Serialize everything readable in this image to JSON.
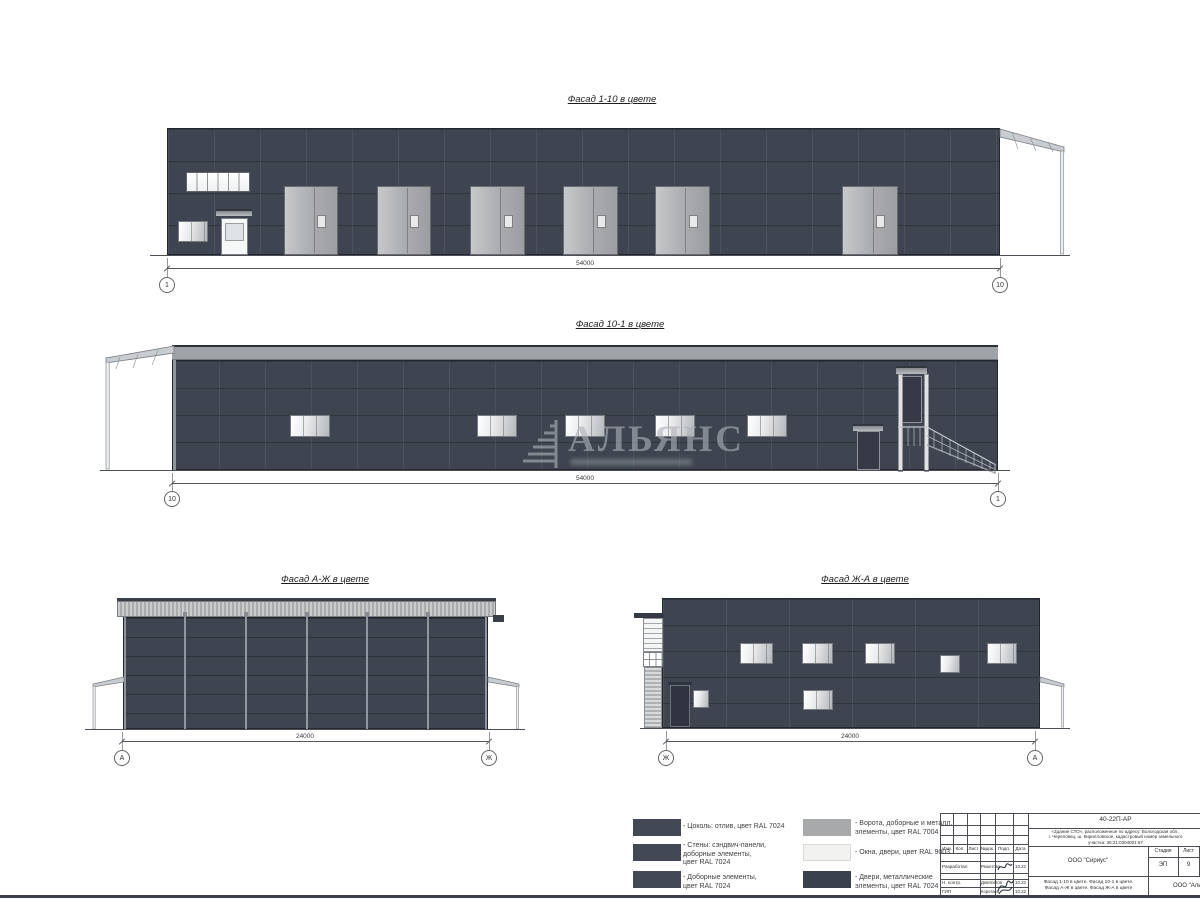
{
  "watermark": {
    "text": "АЛЬЯНС",
    "logo": "alliance-triangle-logo"
  },
  "facades": [
    {
      "title": "Фасад 1-10 в цвете",
      "dimension": "54000",
      "marker_left": "1",
      "marker_right": "10"
    },
    {
      "title": "Фасад 10-1 в цвете",
      "dimension": "54000",
      "marker_left": "10",
      "marker_right": "1"
    },
    {
      "title": "Фасад А-Ж в цвете",
      "dimension": "24000",
      "marker_left": "А",
      "marker_right": "Ж"
    },
    {
      "title": "Фасад Ж-А в цвете",
      "dimension": "24000",
      "marker_left": "Ж",
      "marker_right": "А"
    }
  ],
  "legend": {
    "items": [
      {
        "swatch": "#424854",
        "label": "- Цоколь: отлив, цвет RAL 7024"
      },
      {
        "swatch": "#424854",
        "label": "- Стены: сэндвич-панели,\nдоборные элементы,\nцвет RAL 7024"
      },
      {
        "swatch": "#424854",
        "label": "- Доборные элементы,\nцвет RAL 7024"
      },
      {
        "swatch": "#a7a9ab",
        "label": "- Ворота, доборные и металл.\nэлементы, цвет RAL 7004"
      },
      {
        "swatch": "#f2f3f0",
        "label": "- Окна, двери, цвет RAL 9003"
      },
      {
        "swatch": "#3a404c",
        "label": "- Двери, металлические\nэлементы, цвет RAL 7024"
      }
    ]
  },
  "title_block": {
    "doc_number": "40-22П-АР",
    "project_description": "«Здание СТО», расположенное по адресу: Вологодская обл.,\nг. Череповец, ш. Кирилловское, кадастровый номер земельного\nучастка: 35:21:0304001:67",
    "columns": [
      "Изм.",
      "Коп.",
      "Лист",
      "№док.",
      "Подп.",
      "Дата"
    ],
    "rows": [
      {
        "role": "Разработал",
        "name": "Решетова",
        "date": "10.22"
      },
      {
        "role": "Н. контр.",
        "name": "Девятилов",
        "date": "10.22"
      },
      {
        "role": "ГИП",
        "name": "Коротаев",
        "date": "10.22"
      }
    ],
    "customer": "ООО \"Сириус\"",
    "stage_label": "Стадия",
    "sheet_label": "Лист",
    "stage_value": "ЭП",
    "sheet_value": "9",
    "content": "Фасад 1-10 в цвете. Фасад 10-1 в цвете.\nФасад А-Ж в цвете. Фасад Ж-А в цвете",
    "executor": "ООО \"Альянс\""
  },
  "colors": {
    "wall_ral7024": "#3e4450",
    "band_ral7004": "#9fa2a6",
    "gate_ral7004": "#a8abae",
    "window_ral9003": "#f2f3f0",
    "door_metal_ral7024": "#353a46"
  }
}
